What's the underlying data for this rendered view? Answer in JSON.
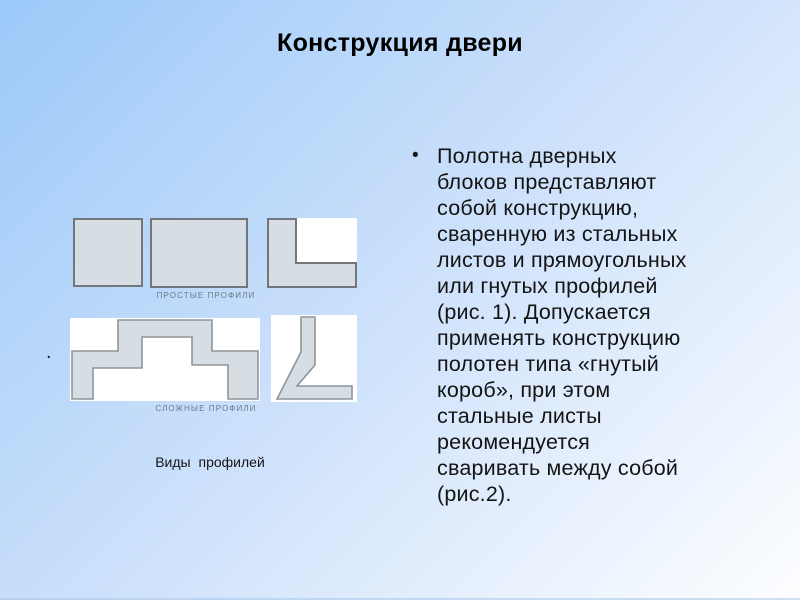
{
  "slide": {
    "title": "Конструкция двери",
    "body": {
      "bullet_marker": "•",
      "text": "Полотна дверных\nблоков представляют\nсобой конструкцию,\nсваренную из стальных\nлистов и прямоугольных\nили гнутых профилей\n(рис. 1). Допускается\nприменять конструкцию\nполотен типа «гнутый\nкороб», при этом\nстальные листы\nрекомендуется\nсваривать между собой\n(рис.2)."
    },
    "stray_bullet": "."
  },
  "figure": {
    "labels": {
      "simple": "ПРОСТЫЕ ПРОФИЛИ",
      "complex": "СЛОЖНЫЕ ПРОФИЛИ"
    },
    "caption": "Виды профилей"
  },
  "colors": {
    "bg-start": "#9cc9f9",
    "bg-mid": "#cfe2fb",
    "bg-end": "#fdfeff",
    "title-color": "#000000",
    "body-color": "#141414",
    "profile-fill": "#d7dee3",
    "profile-stroke-dark": "#73777b",
    "profile-stroke-light": "#8d959b",
    "label-color": "#68798a",
    "figure-bg": "#ffffff",
    "bottom-line": "#a9c6e8"
  }
}
